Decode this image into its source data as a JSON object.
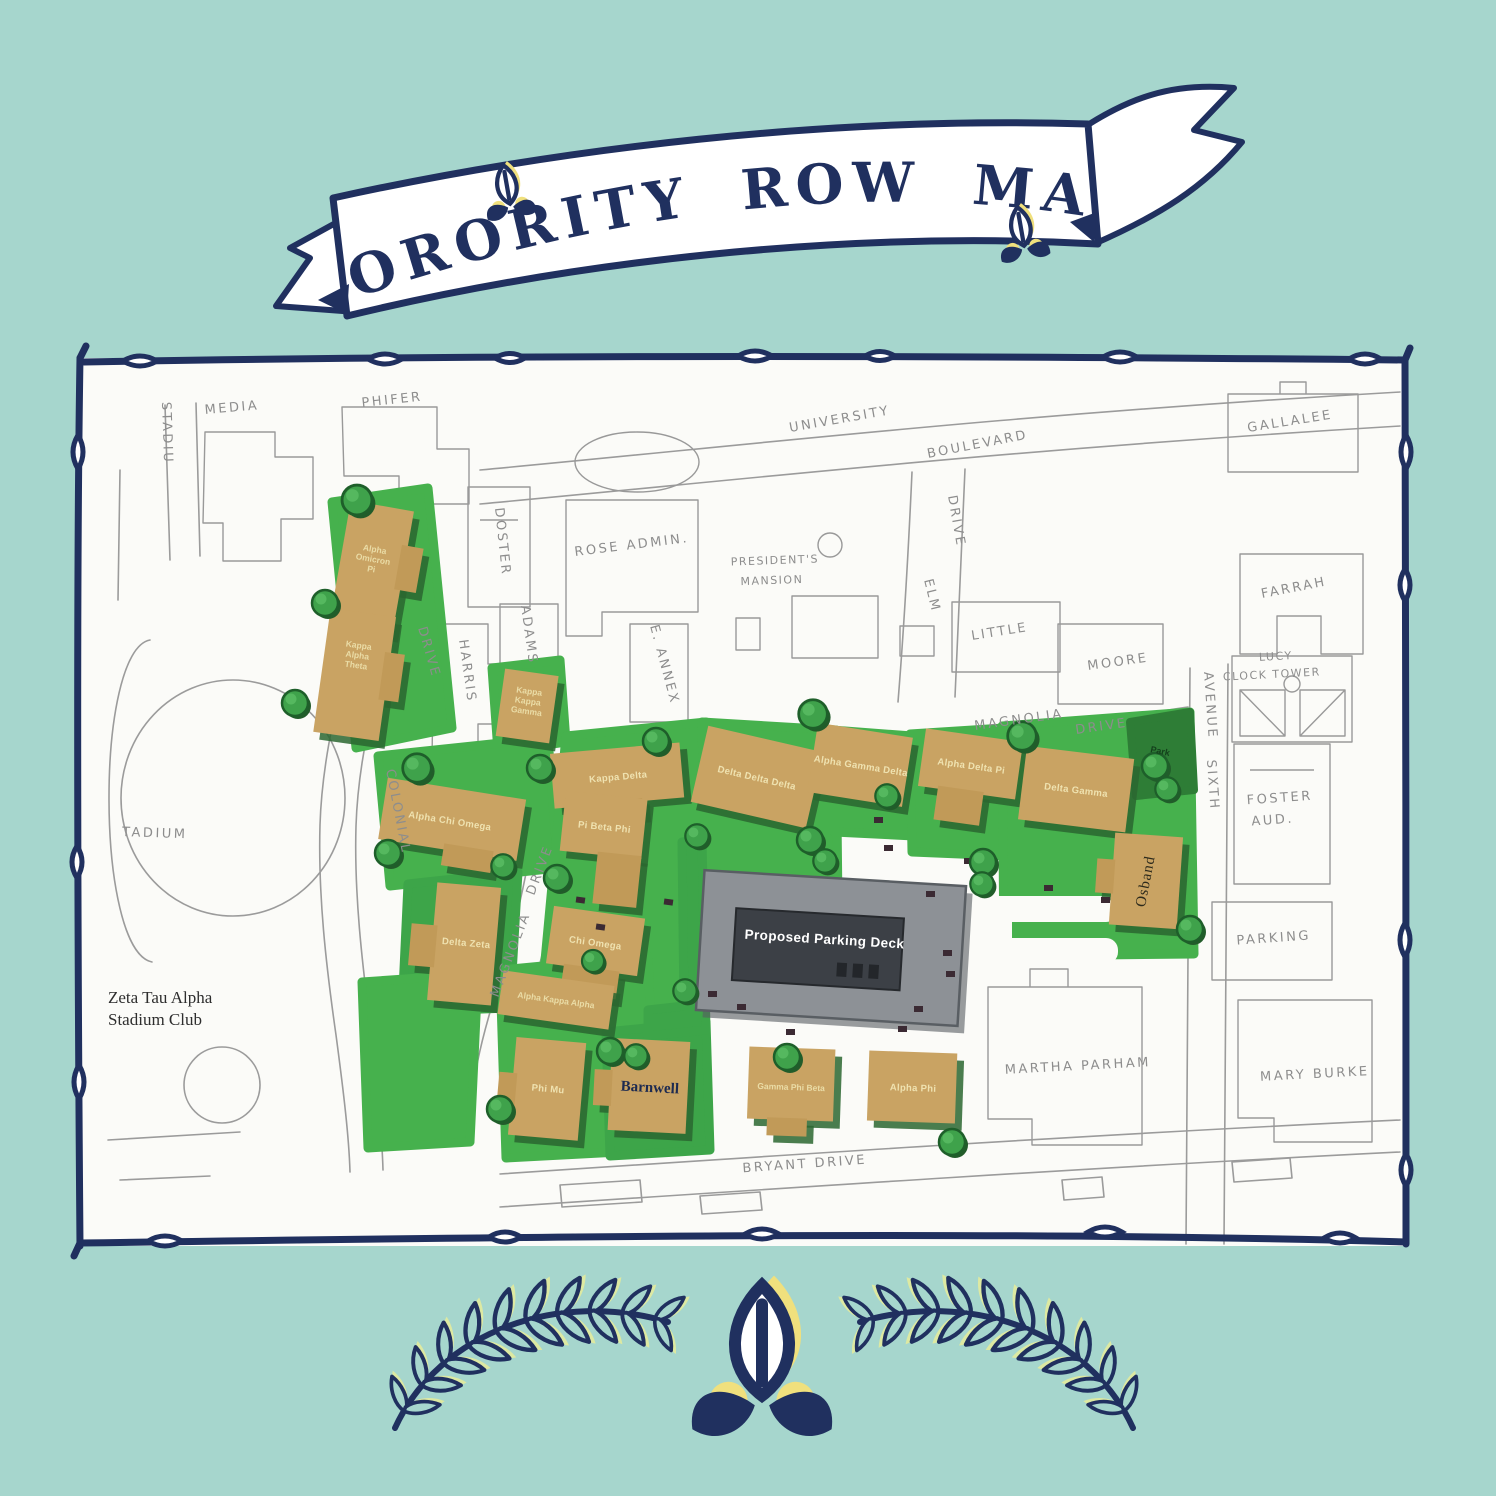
{
  "banner": {
    "title": "SORORITY ROW MAP"
  },
  "map": {
    "streets": {
      "university": "UNIVERSITY",
      "boulevard": "BOULEVARD",
      "magnolia_upper": "MAGNOLIA",
      "magnolia_upper_drive": "DRIVE",
      "magnolia_center": "MAGNOLIA",
      "magnolia_center_drive": "DRIVE",
      "colonial": "COLONIAL",
      "colonial_drive": "DRIVE",
      "elm": "ELM",
      "elm_drive": "DRIVE",
      "sixth": "SIXTH",
      "sixth_avenue": "AVENUE",
      "bryant_drive": "BRYANT  DRIVE"
    },
    "campus_buildings": {
      "stadium_top": "STADIU",
      "media": "MEDIA",
      "phifer": "PHIFER",
      "gallalee": "GALLALEE",
      "doster": "DOSTER",
      "rose_admin": "ROSE  ADMIN.",
      "presidents_mansion_line1": "PRESIDENT'S",
      "presidents_mansion_line2": "MANSION",
      "farrah": "FARRAH",
      "little": "LITTLE",
      "moore": "MOORE",
      "adams": "ADAMS",
      "harris": "HARRIS",
      "e_annex": "E. ANNEX",
      "lucy_line1": "LUCY",
      "lucy_line2": "CLOCK  TOWER",
      "foster_line1": "FOSTER",
      "foster_line2": "AUD.",
      "parking": "PARKING",
      "stadium_left": "TADIUM",
      "martha_parham": "MARTHA  PARHAM",
      "mary_burke": "MARY  BURKE",
      "zeta_tau_alpha_line1": "Zeta Tau Alpha",
      "zeta_tau_alpha_line2": "Stadium Club",
      "park": "Park"
    },
    "houses": {
      "alpha_omicron_pi": "Alpha\nOmicron\nPi",
      "kappa_alpha_theta": "Kappa\nAlpha\nTheta",
      "kappa_kappa_gamma": "Kappa\nKappa\nGamma",
      "alpha_chi_omega": "Alpha Chi Omega",
      "delta_zeta": "Delta Zeta",
      "kappa_delta": "Kappa Delta",
      "pi_beta_phi": "Pi Beta Phi",
      "chi_omega": "Chi Omega",
      "alpha_kappa_alpha": "Alpha Kappa Alpha",
      "phi_mu": "Phi Mu",
      "barnwell": "Barnwell",
      "delta_delta_delta": "Delta Delta Delta",
      "alpha_gamma_delta": "Alpha Gamma Delta",
      "alpha_delta_pi": "Alpha Delta Pi",
      "delta_gamma": "Delta Gamma",
      "osband": "Osband",
      "gamma_phi_beta": "Gamma Phi Beta",
      "alpha_phi": "Alpha Phi"
    },
    "parking_deck": "Proposed Parking Deck"
  },
  "colors": {
    "background": "#a6d6cd",
    "navy": "#20305f",
    "yellow": "#f0e07d",
    "leaf_yellow_green": "#dde9a2",
    "lawn_green": "#46b14d",
    "park_dark_green": "#2e7d36",
    "house_tan": "#c9a363",
    "deck_gray": "#8d9196",
    "map_white": "#fbfbf8"
  }
}
